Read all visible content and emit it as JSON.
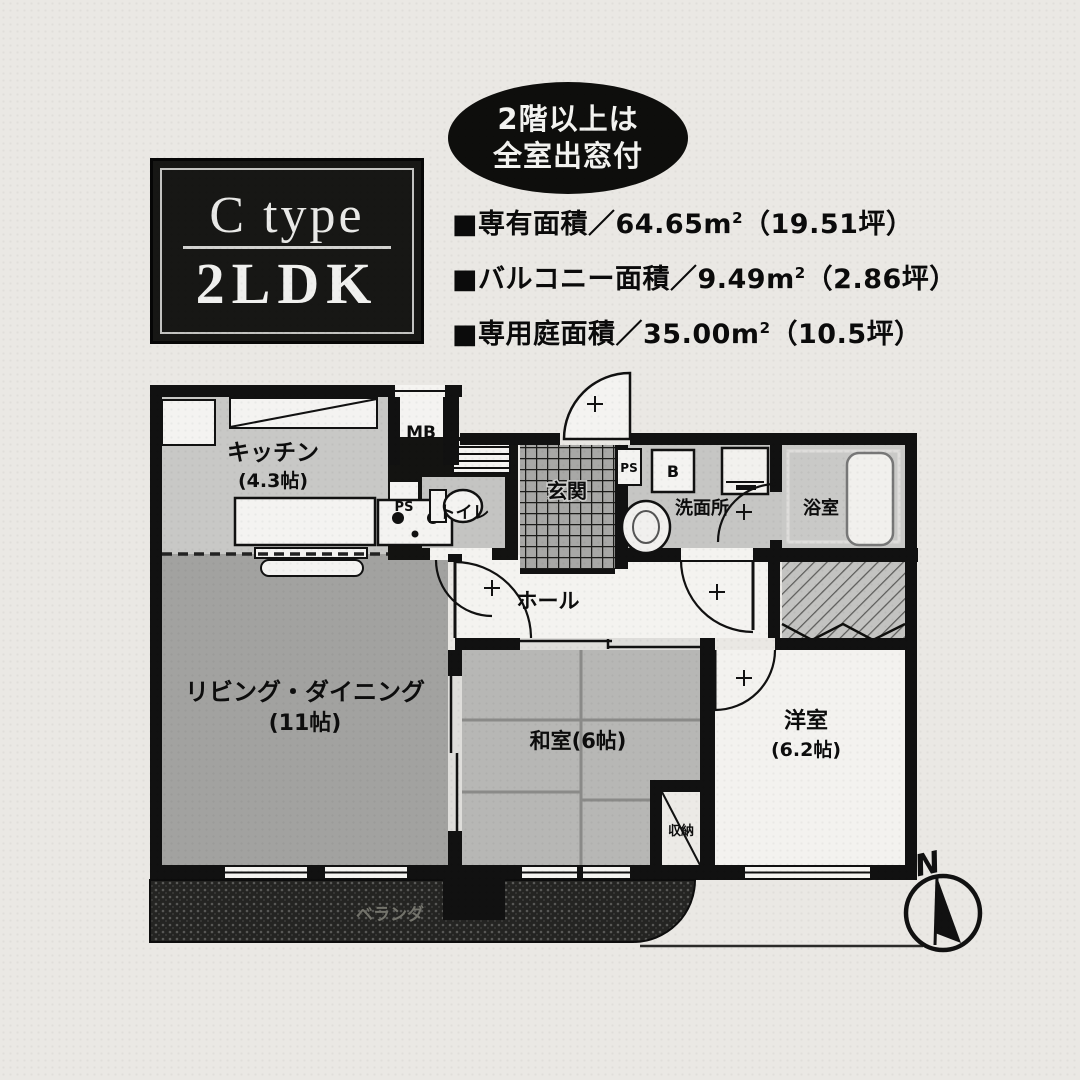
{
  "badge": {
    "type_line": "C type",
    "ldk_line": "2LDK"
  },
  "oval": {
    "line1": "2階以上は",
    "line2": "全室出窓付"
  },
  "specs": [
    {
      "text": "■専有面積／64.65m",
      "sup": "2",
      "suffix": "（19.51坪）"
    },
    {
      "text": "■バルコニー面積／9.49m",
      "sup": "2",
      "suffix": "（2.86坪）"
    },
    {
      "text": "■専用庭面積／35.00m",
      "sup": "2",
      "suffix": "（10.5坪）"
    }
  ],
  "rooms": {
    "kitchen": "キッチン",
    "kitchen_size": "(4.3帖)",
    "meter_box": "MB",
    "pipe_space_toilet": "PS",
    "toilet": "トイレ",
    "entrance": "玄関",
    "pipe_space_hall": "PS",
    "boiler": "B",
    "washroom": "洗面所",
    "bathroom": "浴室",
    "hall": "ホール",
    "living_dining": "リビング・ダイニング",
    "living_dining_size": "(11帖)",
    "japanese_room": "和室(6帖)",
    "western_room": "洋室",
    "western_room_size": "(6.2帖)",
    "closet": "収納",
    "veranda": "ベランダ"
  },
  "compass": {
    "north": "N"
  },
  "colors": {
    "wall": "#111111",
    "living_floor": "#a2a2a0",
    "kitchen_floor": "#c8c8c6",
    "tatami_floor": "#b7b7b5",
    "wet_floor": "#c6c6c4",
    "veranda_dark": "#242422",
    "badge_bg": "#171715",
    "paper_bg": "#eae8e4"
  }
}
